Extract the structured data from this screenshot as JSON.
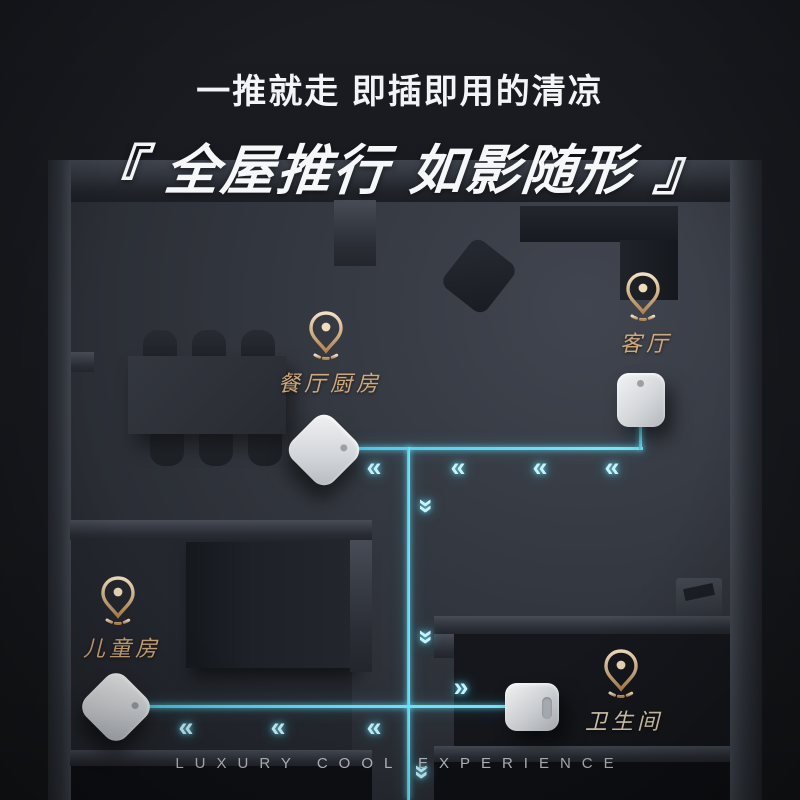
{
  "header": {
    "subtitle": "一推就走 即插即用的清凉",
    "title": "『 全屋推行 如影随形 』"
  },
  "footer": {
    "caption": "LUXURY COOL EXPERIENCE"
  },
  "rooms": [
    {
      "id": "dining-kitchen",
      "label": "餐厅厨房"
    },
    {
      "id": "living-room",
      "label": "客厅"
    },
    {
      "id": "kids-room",
      "label": "儿童房"
    },
    {
      "id": "bathroom",
      "label": "卫生间"
    }
  ],
  "devices": [
    {
      "room": "dining-kitchen",
      "style": "diamond"
    },
    {
      "room": "living-room",
      "style": "upright"
    },
    {
      "room": "kids-room",
      "style": "diamond"
    },
    {
      "room": "bathroom",
      "style": "upright"
    }
  ],
  "icons": {
    "chevron_left": "«",
    "chevron_right": "»",
    "chevron_down": "»",
    "location_pin": "map-pin-outline-with-dot"
  },
  "colors": {
    "accent_cyan": "#5ddcf5",
    "accent_gold": "#cfa97a",
    "title_white": "#f6f7f8",
    "caption_gray": "#bcc0c6",
    "background": "#17191e"
  }
}
